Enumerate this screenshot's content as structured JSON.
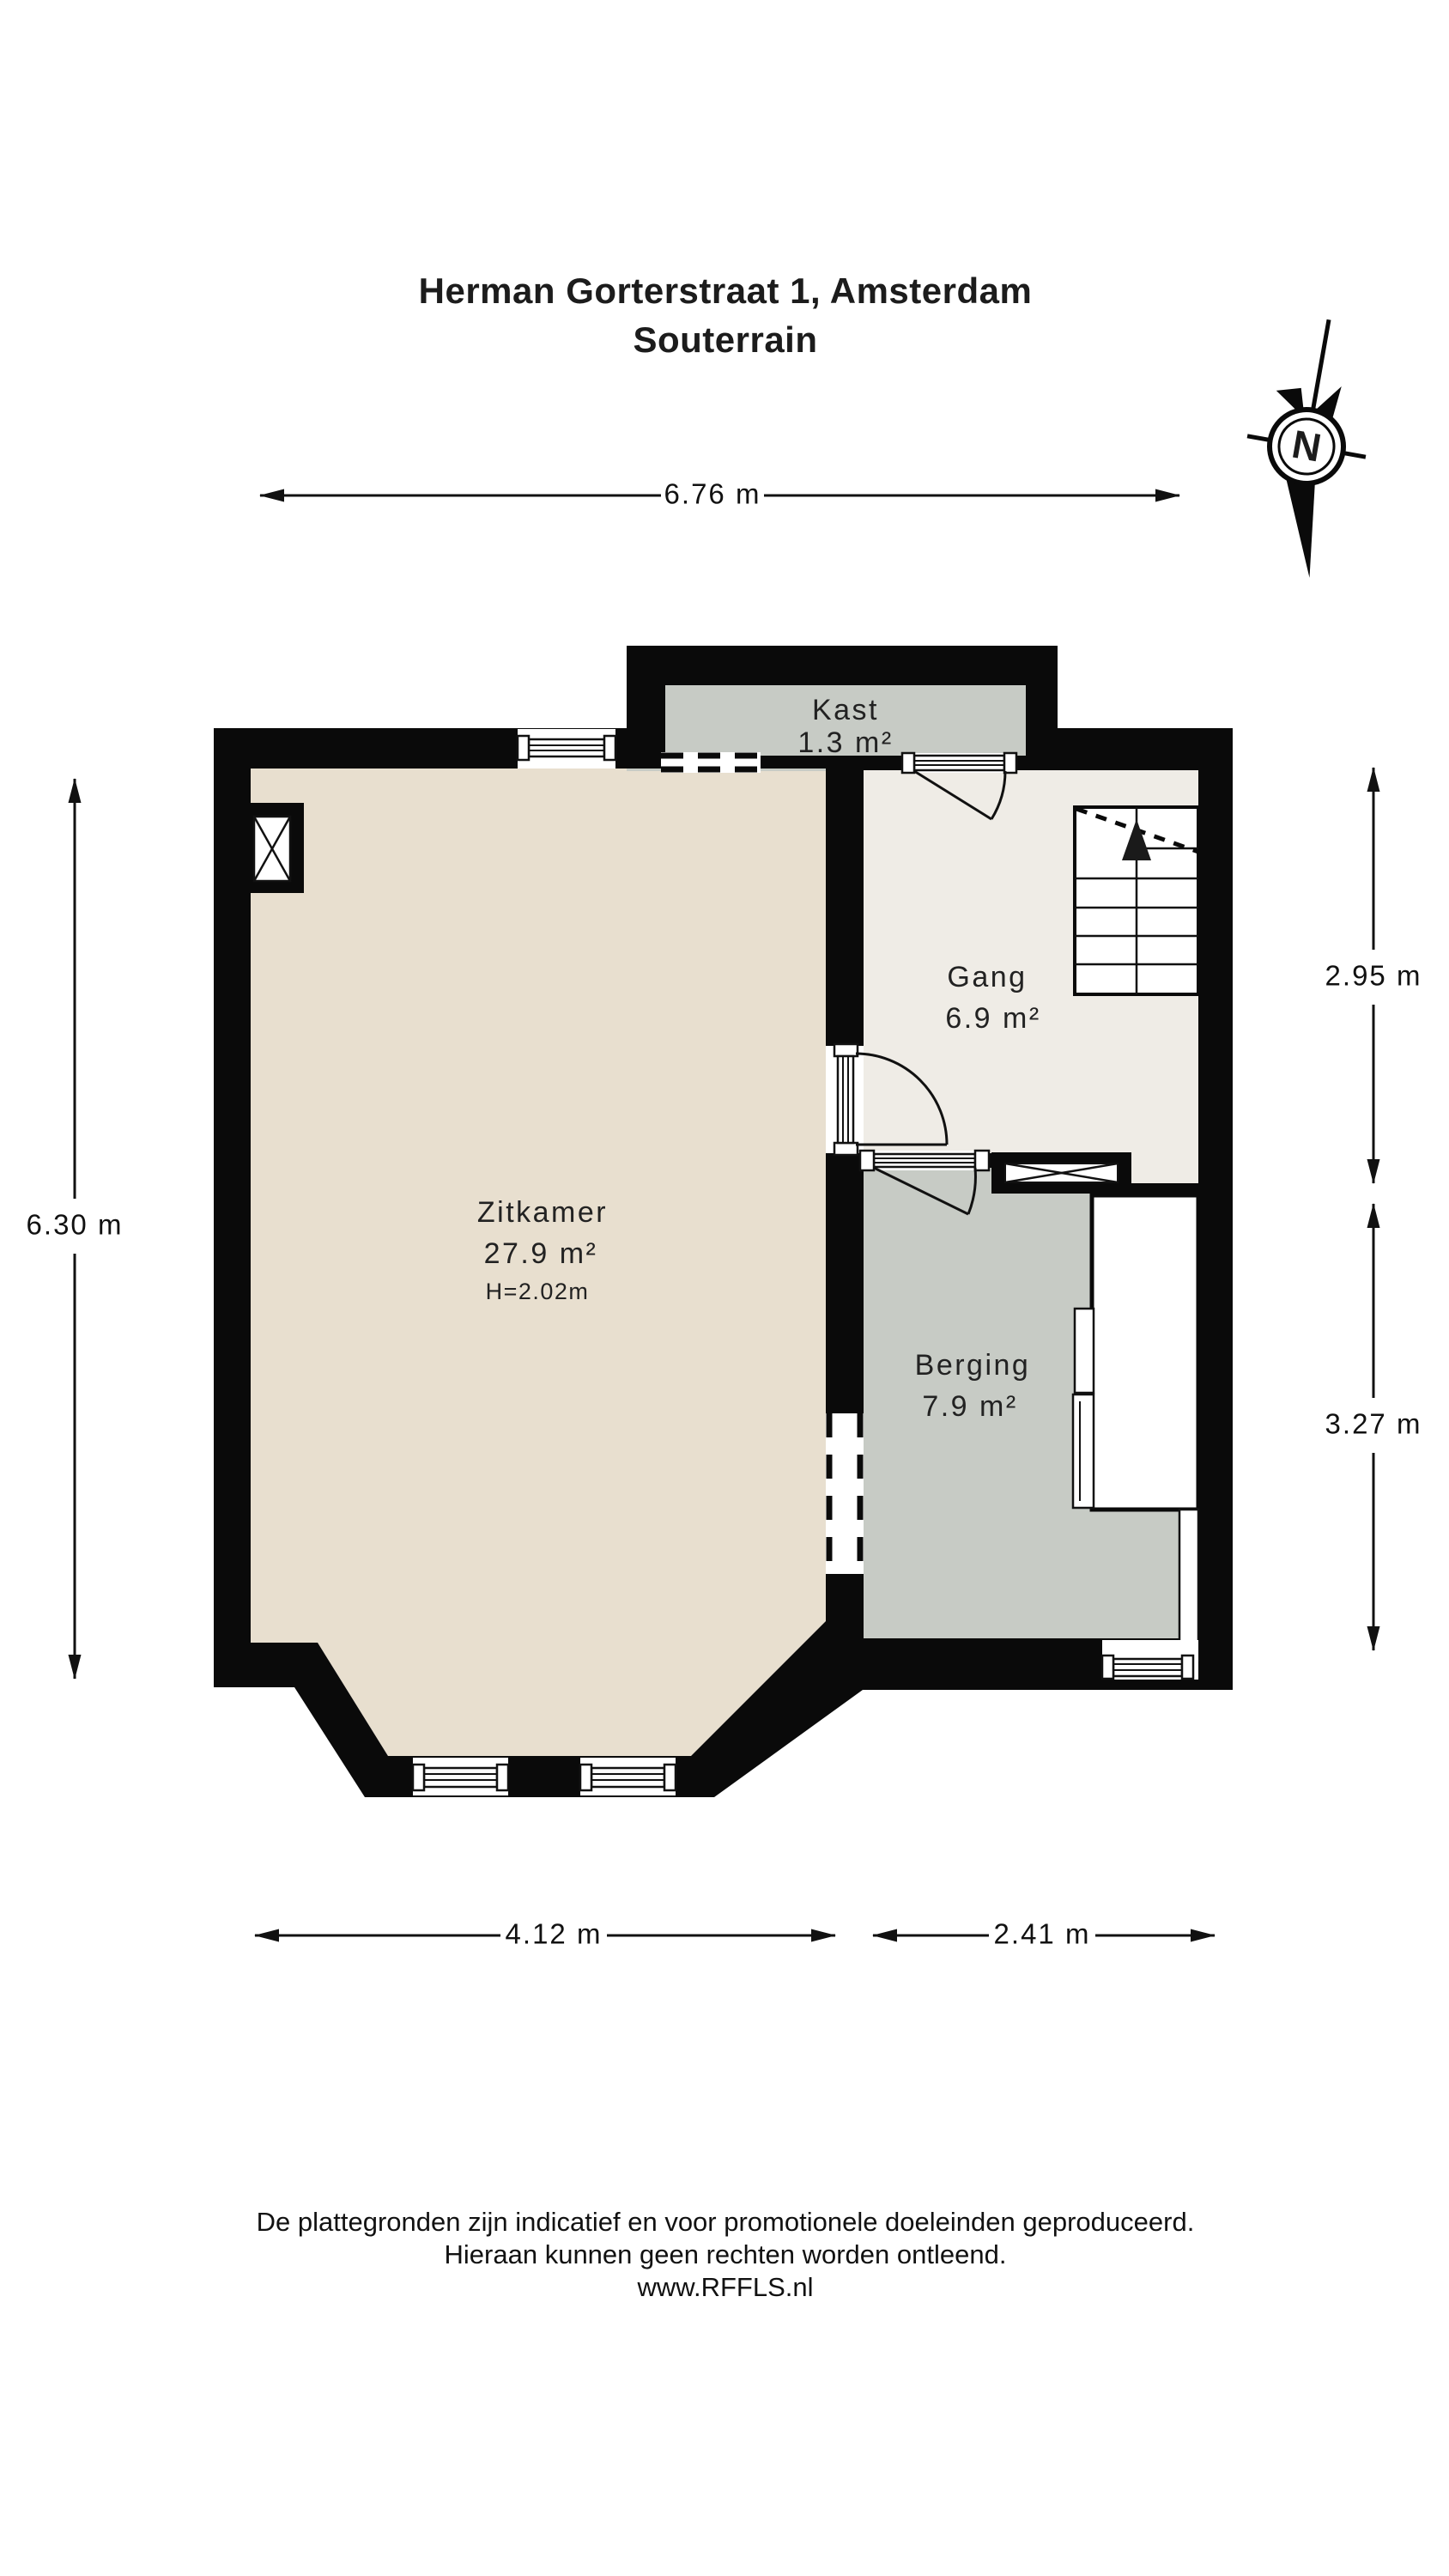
{
  "title": {
    "line1": "Herman Gorterstraat 1, Amsterdam",
    "line2": "Souterrain"
  },
  "compass": {
    "label": "N"
  },
  "dimensions": {
    "top": "6.76 m",
    "left": "6.30 m",
    "right_upper": "2.95 m",
    "right_lower": "3.27 m",
    "bottom_left": "4.12 m",
    "bottom_right": "2.41 m"
  },
  "rooms": {
    "kast": {
      "name": "Kast",
      "area": "1.3 m²"
    },
    "gang": {
      "name": "Gang",
      "area": "6.9 m²"
    },
    "zitkamer": {
      "name": "Zitkamer",
      "area": "27.9 m²",
      "height": "H=2.02m"
    },
    "berging": {
      "name": "Berging",
      "area": "7.9 m²"
    }
  },
  "footer": {
    "line1": "De plattegronden zijn indicatief en voor promotionele doeleinden geproduceerd.",
    "line2": "Hieraan kunnen geen rechten worden ontleend.",
    "line3": "www.RFFLS.nl"
  },
  "colors": {
    "wall": "#0a0a0a",
    "zitkamer_floor": "#e8dfcf",
    "gang_floor": "#efece6",
    "kast_floor": "#c7cbc5",
    "berging_floor": "#c7cbc5"
  }
}
